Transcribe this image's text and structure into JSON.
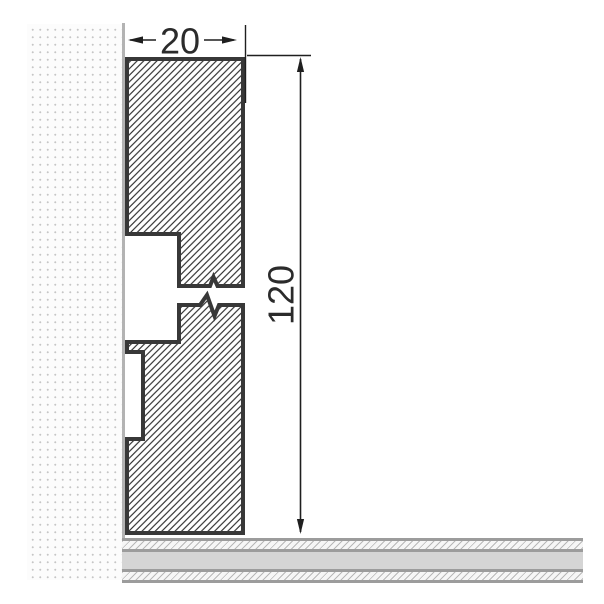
{
  "drawing": {
    "dimensions": {
      "width": {
        "value": "20"
      },
      "height": {
        "value": "120"
      }
    },
    "colors": {
      "profile_outline": "#383838",
      "hatch_line": "#2e2e2e",
      "dimension_line": "#1f1f1f",
      "dimension_text": "#2b2b2b",
      "wall_dots": "#c6c6c6",
      "wall_edge": "#b3b3b3",
      "floor_border": "#9c9c9c",
      "floor_slab_fill": "#d5d5d5",
      "floor_hatch_line": "#b8b8b8"
    }
  }
}
